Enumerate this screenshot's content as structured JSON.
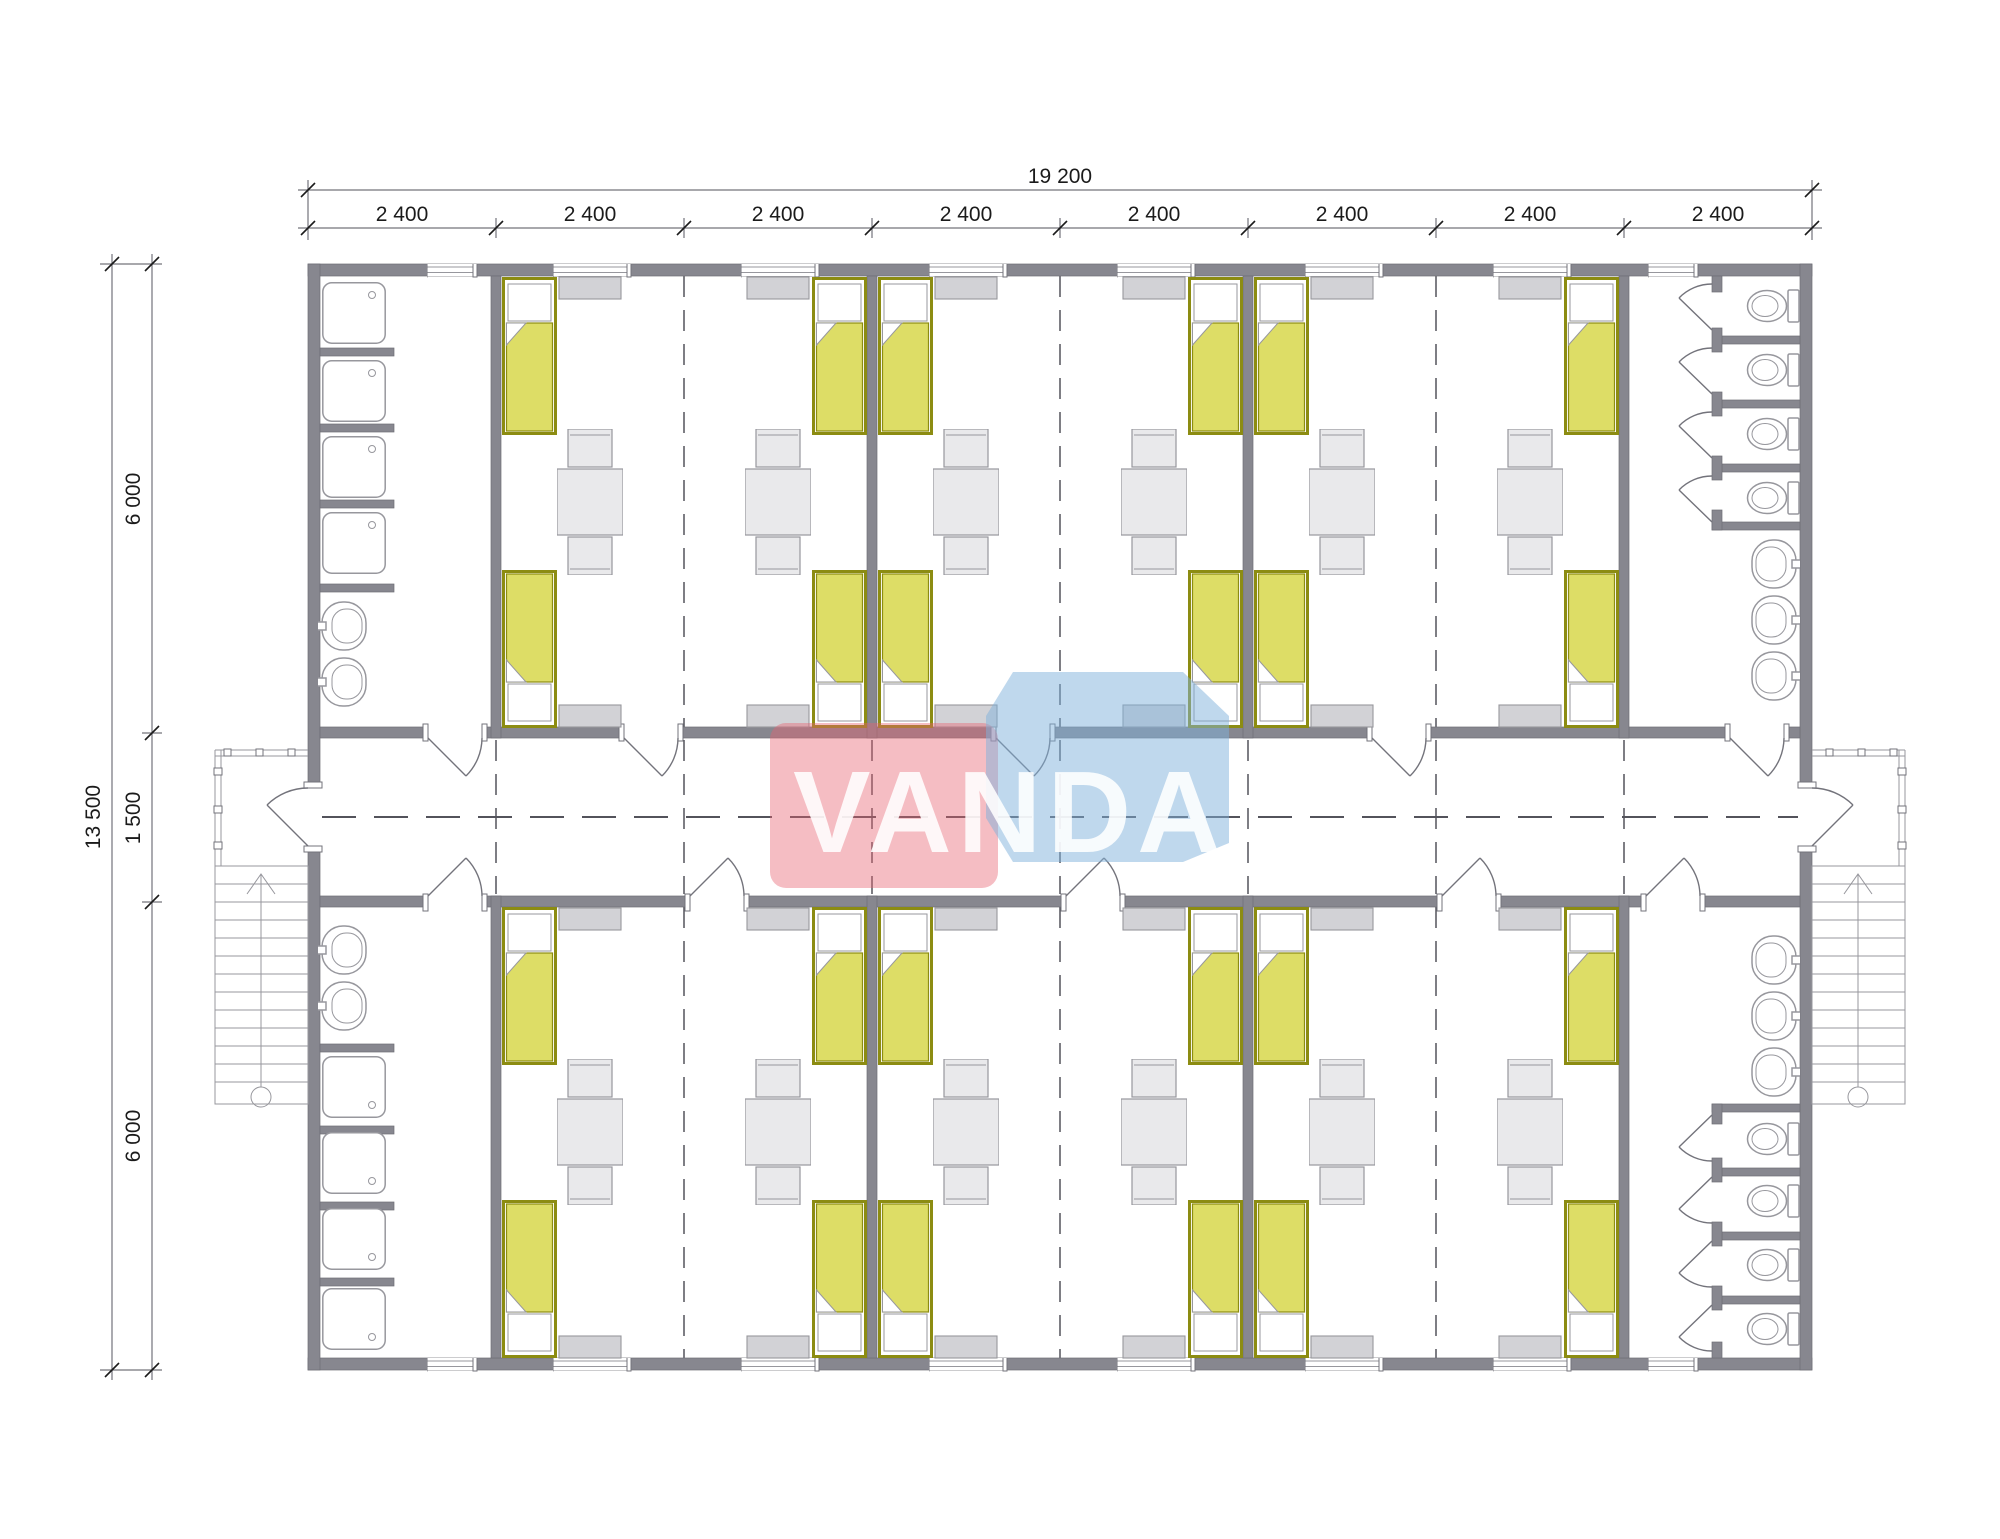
{
  "watermark": {
    "text": "VANDA"
  },
  "dimensions": {
    "top": {
      "total": "19 200",
      "segments": [
        "2 400",
        "2 400",
        "2 400",
        "2 400",
        "2 400",
        "2 400",
        "2 400",
        "2 400"
      ]
    },
    "left": {
      "total": "13 500",
      "segments": [
        "6 000",
        "1 500",
        "6 000"
      ]
    }
  },
  "colors": {
    "wall": "#87878F",
    "line": "#73737B",
    "dash": "#53535B",
    "text": "#1B1B1B",
    "bed_fill": "#DDDD66",
    "bed_border": "#8C8C12",
    "furn_fill": "#E9E9EB",
    "furn_border": "#97979D",
    "rad_fill": "#D2D2D6",
    "wm_red": "#E8626F",
    "wm_blue": "#7FB2DC",
    "wm_text": "#FFFFFF"
  },
  "plan": {
    "building": {
      "modules_across": 8,
      "module_width_label": "2 400",
      "overall_width_label": "19 200",
      "overall_depth_label": "13 500",
      "room_band_depth_label": "6 000",
      "corridor_depth_label": "1 500"
    },
    "rooms": [
      {
        "id": "room-upper-1",
        "beds": 4,
        "tables": 2,
        "chairs": 4,
        "windows": 2,
        "side_units": 4,
        "doors": 1
      },
      {
        "id": "room-upper-2",
        "beds": 4,
        "tables": 2,
        "chairs": 4,
        "windows": 2,
        "side_units": 4,
        "doors": 1
      },
      {
        "id": "room-upper-3",
        "beds": 4,
        "tables": 2,
        "chairs": 4,
        "windows": 2,
        "side_units": 4,
        "doors": 1
      },
      {
        "id": "room-lower-1",
        "beds": 4,
        "tables": 2,
        "chairs": 4,
        "windows": 2,
        "side_units": 4,
        "doors": 1
      },
      {
        "id": "room-lower-2",
        "beds": 4,
        "tables": 2,
        "chairs": 4,
        "windows": 2,
        "side_units": 4,
        "doors": 1
      },
      {
        "id": "room-lower-3",
        "beds": 4,
        "tables": 2,
        "chairs": 4,
        "windows": 2,
        "side_units": 4,
        "doors": 1
      }
    ],
    "washrooms": [
      {
        "id": "washroom-upper-left",
        "showers": 4,
        "sinks": 2,
        "windows": 1,
        "doors": 1
      },
      {
        "id": "washroom-upper-right",
        "toilets": 4,
        "sinks": 3,
        "windows": 1,
        "doors": 1
      },
      {
        "id": "washroom-lower-left",
        "showers": 4,
        "sinks": 2,
        "windows": 1,
        "doors": 1
      },
      {
        "id": "washroom-lower-right",
        "toilets": 4,
        "sinks": 3,
        "windows": 1,
        "doors": 1
      }
    ],
    "entrances": [
      {
        "id": "entrance-left",
        "porch": true,
        "stairs": true
      },
      {
        "id": "entrance-right",
        "porch": true,
        "stairs": true
      }
    ]
  }
}
